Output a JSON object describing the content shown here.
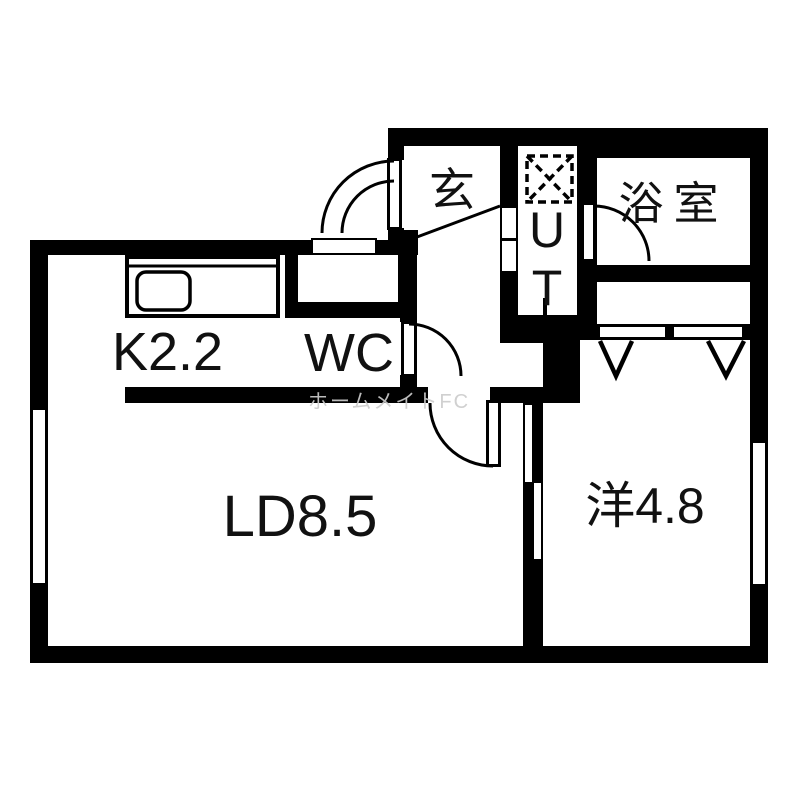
{
  "floorplan": {
    "title": "apartment-floor-plan",
    "rooms": {
      "genkan": "玄",
      "ut": "UT",
      "bathroom": "浴室",
      "wc": "WC",
      "kitchen": "K2.2",
      "living_dining": "LD8.5",
      "western_room": "洋4.8"
    },
    "watermark": "ホームメイトFC",
    "colors": {
      "wall": "#000000",
      "floor": "#ffffff",
      "watermark": "#cdcdcd"
    }
  }
}
